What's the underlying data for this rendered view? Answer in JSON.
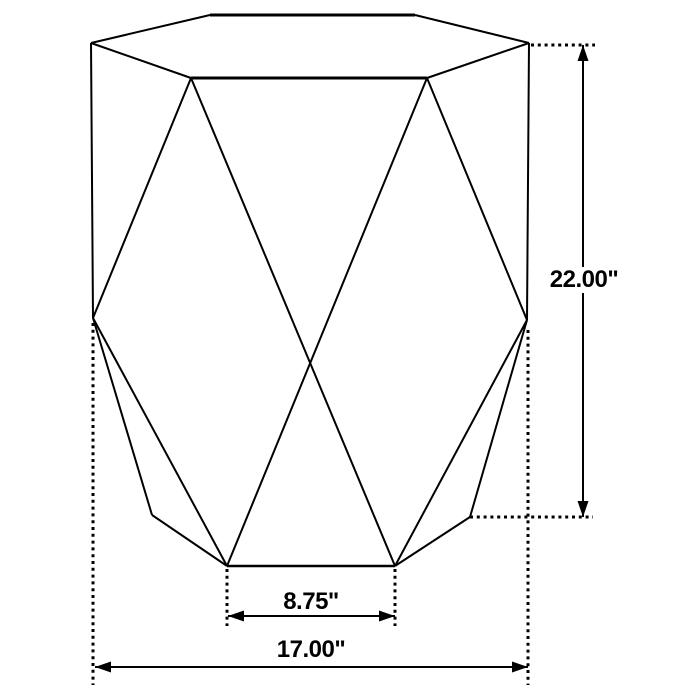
{
  "canvas": {
    "width": 700,
    "height": 700,
    "background": "#ffffff",
    "line_color": "#000000"
  },
  "figure": {
    "description": "hexagonal faceted drum side table line drawing with dimension callouts",
    "solid_lines": [
      [
        91,
        43,
        210,
        15,
        2
      ],
      [
        210,
        15,
        415,
        15,
        3
      ],
      [
        415,
        15,
        529,
        43,
        2
      ],
      [
        529,
        43,
        427,
        78,
        2
      ],
      [
        427,
        78,
        191,
        78,
        3
      ],
      [
        191,
        78,
        91,
        43,
        2
      ],
      [
        91,
        43,
        93,
        318,
        2
      ],
      [
        529,
        43,
        527,
        320,
        2
      ],
      [
        93,
        318,
        152,
        515,
        2
      ],
      [
        152,
        515,
        227,
        566,
        2
      ],
      [
        527,
        320,
        470,
        517,
        2
      ],
      [
        470,
        517,
        395,
        566,
        2
      ],
      [
        227,
        566,
        395,
        566,
        2.5
      ],
      [
        191,
        78,
        93,
        318,
        2
      ],
      [
        427,
        78,
        527,
        320,
        2
      ],
      [
        191,
        78,
        395,
        566,
        2
      ],
      [
        427,
        78,
        227,
        566,
        2
      ],
      [
        93,
        318,
        227,
        566,
        2
      ],
      [
        527,
        320,
        395,
        566,
        2
      ]
    ],
    "dotted_lines": [
      [
        531,
        45,
        595,
        45
      ],
      [
        470,
        517,
        593,
        517
      ],
      [
        93,
        323,
        93,
        685
      ],
      [
        528,
        330,
        528,
        685
      ],
      [
        227,
        569,
        227,
        626
      ],
      [
        395,
        569,
        395,
        626
      ]
    ],
    "dotted_style": {
      "width": 3,
      "dash": "3 3.8"
    },
    "dimension_lines": [
      {
        "id": "height",
        "x1": 583,
        "y1": 45,
        "x2": 583,
        "y2": 517
      },
      {
        "id": "base_width",
        "x1": 228,
        "y1": 616,
        "x2": 395,
        "y2": 616
      },
      {
        "id": "overall_width",
        "x1": 95,
        "y1": 667,
        "x2": 528,
        "y2": 667
      }
    ],
    "arrow_style": {
      "length": 16,
      "half_width": 5.5
    }
  },
  "labels": {
    "height": {
      "text": "22.00\"",
      "x": 584,
      "y": 280
    },
    "base_width": {
      "text": "8.75\"",
      "x": 311,
      "y": 602
    },
    "overall_width": {
      "text": "17.00\"",
      "x": 311,
      "y": 650
    }
  }
}
